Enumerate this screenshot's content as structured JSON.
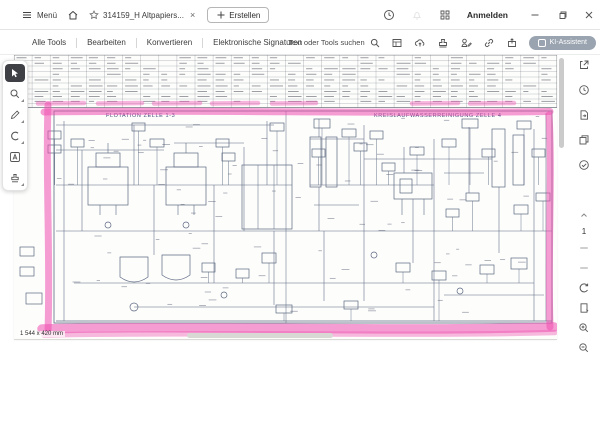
{
  "header": {
    "menu_label": "Menü",
    "tab": {
      "title": "314159_H Altpapiers...",
      "close_glyph": "×"
    },
    "create_button": "Erstellen",
    "signin_button": "Anmelden"
  },
  "toolbar": {
    "tabs": [
      {
        "label": "Alle Tools"
      },
      {
        "label": "Bearbeiten"
      },
      {
        "label": "Konvertieren"
      },
      {
        "label": "Elektronische Signaturen"
      }
    ],
    "search_placeholder": "Text oder Tools suchen",
    "ai_assistant_button": "KI-Assistent"
  },
  "viewer": {
    "page_number": "1",
    "size_label": "1 544 x 420 mm",
    "diagram": {
      "left_section_title": "FLOTATION ZELLE 1-3",
      "right_section_title": "KREISLAUFWASSERREINIGUNG ZELLE 4"
    },
    "highlight_color": "#ee4fb0",
    "line_color": "#5c6880"
  }
}
